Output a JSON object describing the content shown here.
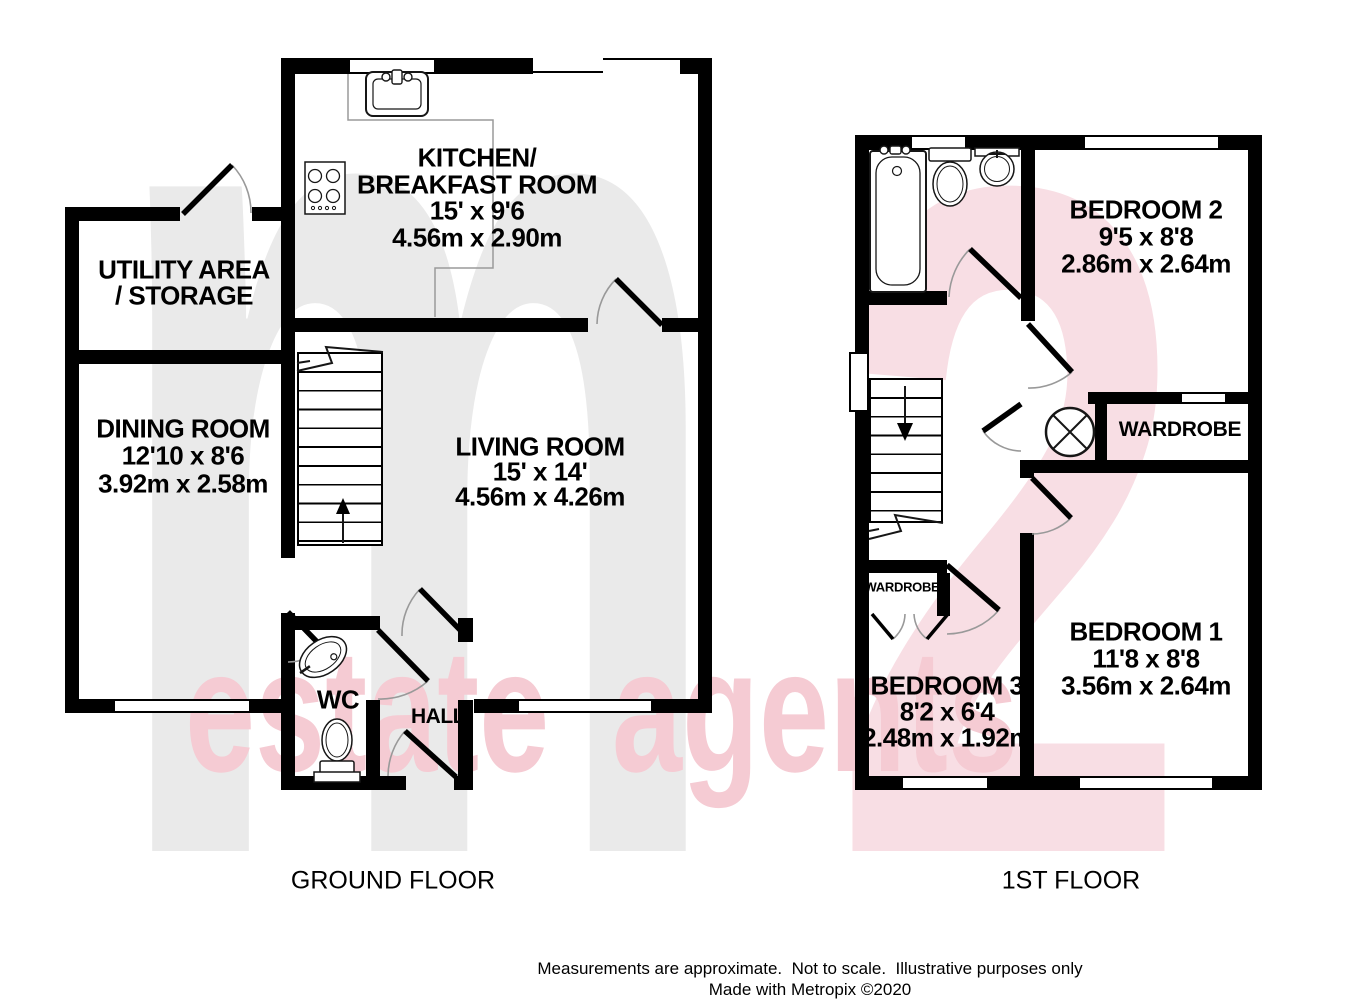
{
  "watermark": {
    "letter": "m",
    "number": "2",
    "text": "estate agents"
  },
  "ground_floor": {
    "title": "GROUND FLOOR",
    "rooms": {
      "kitchen": {
        "name_line1": "KITCHEN/",
        "name_line2": "BREAKFAST ROOM",
        "size_imperial": "15' x 9'6",
        "size_metric": "4.56m x 2.90m"
      },
      "utility": {
        "name_line1": "UTILITY AREA",
        "name_line2": "/ STORAGE"
      },
      "dining": {
        "name": "DINING ROOM",
        "size_imperial": "12'10 x 8'6",
        "size_metric": "3.92m x 2.58m"
      },
      "living": {
        "name": "LIVING ROOM",
        "size_imperial": "15' x 14'",
        "size_metric": "4.56m x 4.26m"
      },
      "wc": {
        "name": "WC"
      },
      "hall": {
        "name": "HALL"
      }
    },
    "fixtures": [
      "kitchen-sink",
      "hob",
      "stairs-up",
      "wc-basin",
      "wc-toilet"
    ]
  },
  "first_floor": {
    "title": "1ST FLOOR",
    "rooms": {
      "bedroom2": {
        "name": "BEDROOM 2",
        "size_imperial": "9'5 x 8'8",
        "size_metric": "2.86m x 2.64m"
      },
      "bedroom1": {
        "name": "BEDROOM 1",
        "size_imperial": "11'8 x 8'8",
        "size_metric": "3.56m x 2.64m"
      },
      "bedroom3": {
        "name": "BEDROOM 3",
        "size_imperial": "8'2 x 6'4",
        "size_metric": "2.48m x 1.92m"
      },
      "wardrobe": {
        "name": "WARDROBE"
      },
      "wardrobe_small": {
        "name": "WARDROBE"
      }
    },
    "fixtures": [
      "bath",
      "toilet",
      "basin",
      "stairs-down",
      "light-symbol",
      "wardrobe-doors"
    ]
  },
  "footer": {
    "line1": "Measurements are approximate.  Not to scale.  Illustrative purposes only",
    "line2": "Made with Metropix ©2020"
  },
  "colors": {
    "wall": "#000000",
    "arc": "#999999",
    "watermark_gray": "#eaeaea",
    "watermark_pink_light": "#f8dee4",
    "watermark_pink_text": "#f5cbd3"
  }
}
